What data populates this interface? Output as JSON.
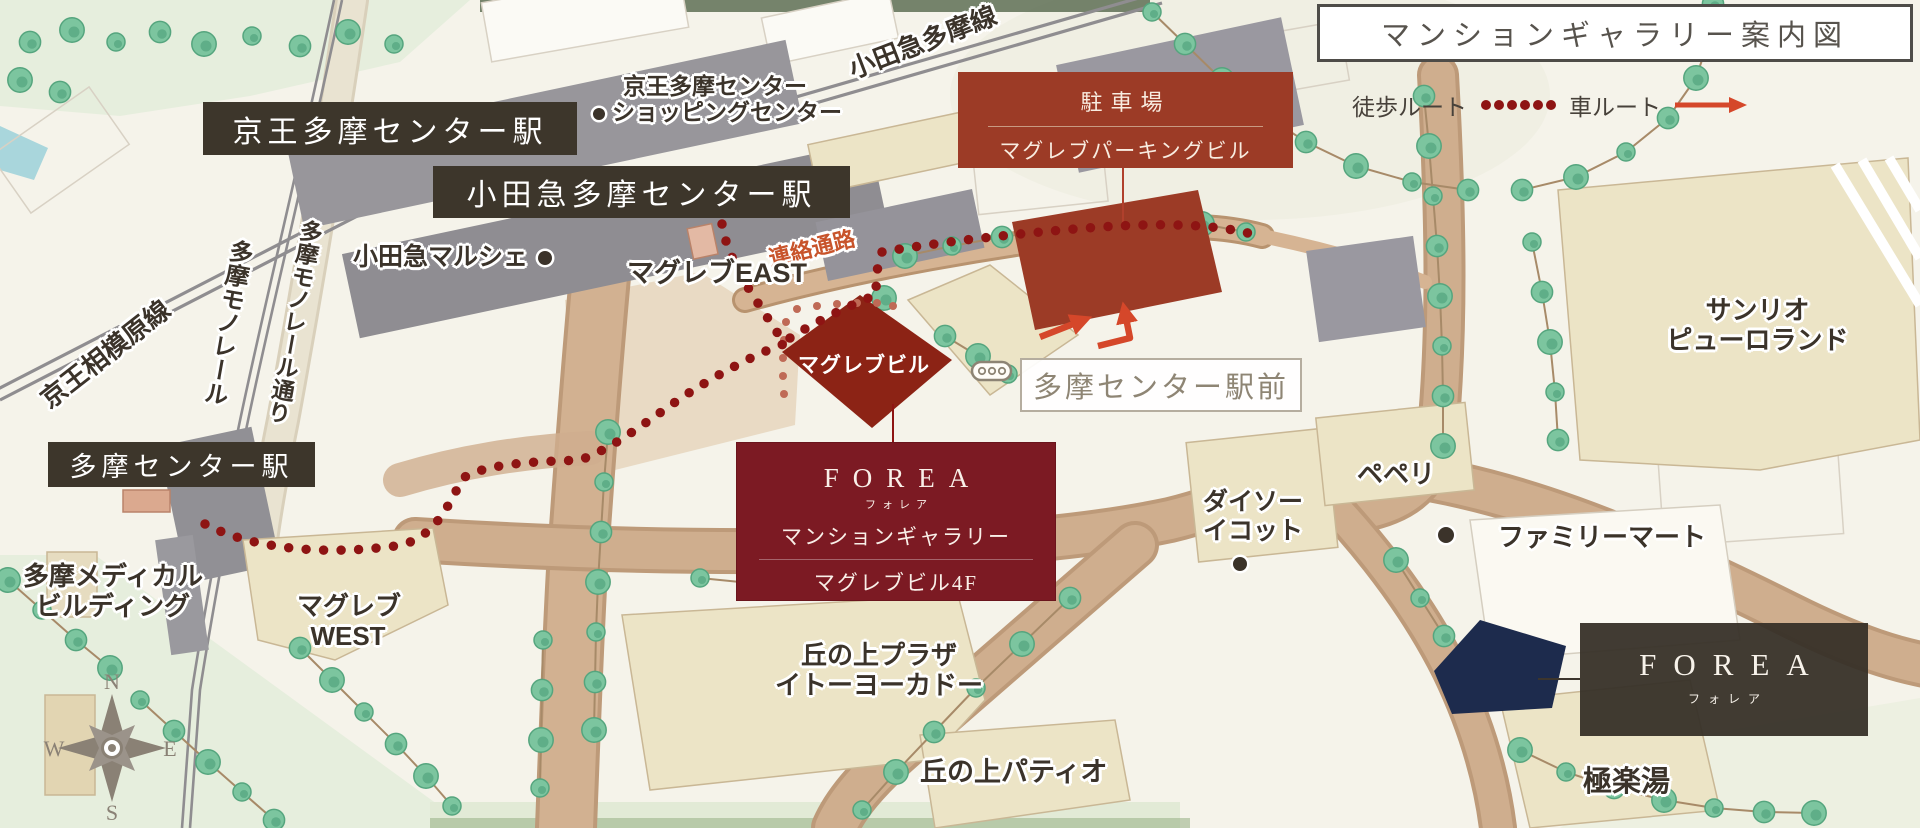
{
  "title": "マンションギャラリー案内図",
  "legend": {
    "walk_label": "徒歩ルート",
    "car_label": "車ルート"
  },
  "stations": {
    "keio": "京王多摩センター駅",
    "odakyu": "小田急多摩センター駅",
    "tama": "多摩センター駅"
  },
  "rail_lines": {
    "odakyu_tama_line": "小田急多摩線",
    "keio_sagamihara_line": "京王相模原線",
    "monorail": "多摩モノレール",
    "monorail_street": "多摩モノレール通り"
  },
  "corridor_label": "連絡通路",
  "parking_box": {
    "line1": "駐車場",
    "line2": "マグレブパーキングビル"
  },
  "gallery_box": {
    "brand": "FOREA",
    "brand_kana": "フォレア",
    "line1": "マンションギャラリー",
    "line2": "マグレブビル4F"
  },
  "site_box": {
    "brand": "FOREA",
    "brand_kana": "フォレア"
  },
  "bus_stop": {
    "label": "多摩センター駅前"
  },
  "landmarks": {
    "shopping_center_line1": "京王多摩センター",
    "shopping_center_line2": "ショッピングセンター",
    "marche": "小田急マルシェ",
    "maglev_east": "マグレブEAST",
    "maglev_bldg": "マグレブビル",
    "maglev_west_line1": "マグレブ",
    "maglev_west_line2": "WEST",
    "medical_line1": "多摩メディカル",
    "medical_line2": "ビルディング",
    "sanrio_line1": "サンリオ",
    "sanrio_line2": "ピューロランド",
    "daiso_line1": "ダイソー",
    "daiso_line2": "イコット",
    "peperi": "ペペリ",
    "familymart": "ファミリーマート",
    "okanoue_plaza_line1": "丘の上プラザ",
    "okanoue_plaza_line2": "イトーヨーカドー",
    "okanoue_patio": "丘の上パティオ",
    "gokurakuyu": "極楽湯"
  },
  "compass": {
    "n": "N",
    "e": "E",
    "s": "S",
    "w": "W"
  },
  "colors": {
    "parking_red": "#9c3b26",
    "gallery_maroon": "#7c1a23",
    "building_dark_red": "#8c2315",
    "site_navy": "#1d2b4d",
    "route_dot_red": "#8e1413",
    "car_route_red": "#d5472a",
    "station_box_brown": "#3d362b",
    "corridor_text_orange": "#c8542b",
    "bus_stop_gray": "#8e8574",
    "road_tan": "#cfae8e",
    "building_beige": "#ece4c6",
    "tree_green": "#7cc59f"
  }
}
